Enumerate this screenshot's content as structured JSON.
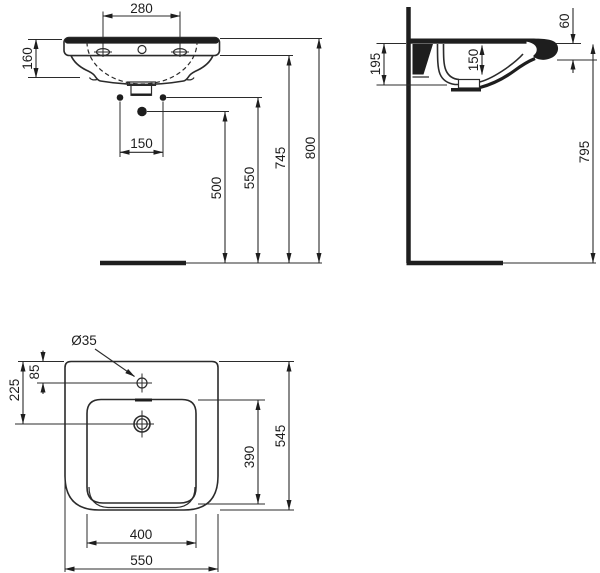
{
  "colors": {
    "line": "#2b2b2b",
    "background": "#ffffff"
  },
  "front_view": {
    "tap_hole_spacing": "280",
    "basin_height": "160",
    "fixing_hole_spacing": "150",
    "height_to_lower_fixing": "500",
    "height_to_fixing_holes": "550",
    "height_to_rim_underside": "745",
    "height_to_rim_top": "800"
  },
  "side_view": {
    "front_edge_height": "60",
    "wall_section_height": "195",
    "bowl_depth": "150",
    "height_to_front_edge": "795"
  },
  "plan_view": {
    "tap_hole_diameter": "Ø35",
    "tap_hole_offset": "85",
    "overflow_offset": "225",
    "bowl_depth_front_to_back": "390",
    "overall_depth": "545",
    "bowl_width": "400",
    "overall_width": "550"
  }
}
